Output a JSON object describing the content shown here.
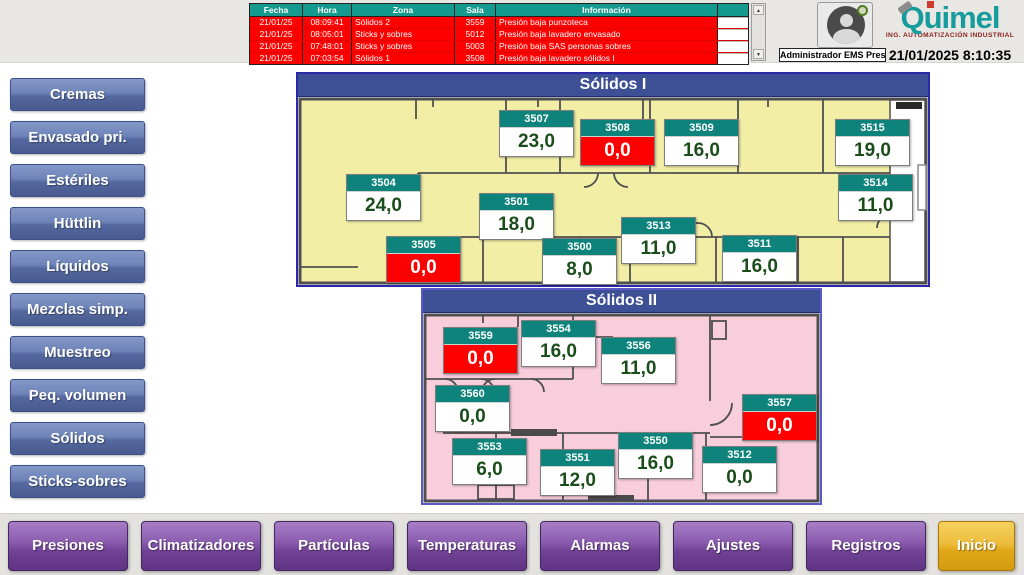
{
  "alarm_table": {
    "headers": [
      "Fecha",
      "Hora",
      "Zona",
      "Sala",
      "Información"
    ],
    "rows": [
      [
        "21/01/25",
        "08:09:41",
        "Sólidos 2",
        "3559",
        "Presión baja punzoteca"
      ],
      [
        "21/01/25",
        "08:05:01",
        "Sticks y sobres",
        "5012",
        "Presión baja lavadero envasado"
      ],
      [
        "21/01/25",
        "07:48:01",
        "Sticks y sobres",
        "5003",
        "Presión baja SAS personas sobres"
      ],
      [
        "21/01/25",
        "07:03:54",
        "Sólidos 1",
        "3508",
        "Presión baja lavadero sólidos I"
      ]
    ]
  },
  "header": {
    "user_label": "Administrador EMS Presiones",
    "logo_text": "Quimel",
    "logo_subtitle": "ING. AUTOMATIZACIÓN INDUSTRIAL",
    "datetime": "21/01/2025 8:10:35"
  },
  "icons": {
    "scroll_up": "▲",
    "scroll_down": "▼"
  },
  "sidebar": {
    "buttons": [
      "Cremas",
      "Envasado pri.",
      "Estériles",
      "Hüttlin",
      "Líquidos",
      "Mezclas simp.",
      "Muestreo",
      "Peq. volumen",
      "Sólidos",
      "Sticks-sobres"
    ]
  },
  "panels": [
    {
      "title": "Sólidos I",
      "rooms": [
        {
          "id": "3507",
          "value": "23,0",
          "alarm": false
        },
        {
          "id": "3508",
          "value": "0,0",
          "alarm": true
        },
        {
          "id": "3509",
          "value": "16,0",
          "alarm": false
        },
        {
          "id": "3515",
          "value": "19,0",
          "alarm": false
        },
        {
          "id": "3504",
          "value": "24,0",
          "alarm": false
        },
        {
          "id": "3501",
          "value": "18,0",
          "alarm": false
        },
        {
          "id": "3514",
          "value": "11,0",
          "alarm": false
        },
        {
          "id": "3505",
          "value": "0,0",
          "alarm": true
        },
        {
          "id": "3500",
          "value": "8,0",
          "alarm": false
        },
        {
          "id": "3513",
          "value": "11,0",
          "alarm": false
        },
        {
          "id": "3511",
          "value": "16,0",
          "alarm": false
        }
      ]
    },
    {
      "title": "Sólidos II",
      "rooms": [
        {
          "id": "3559",
          "value": "0,0",
          "alarm": true
        },
        {
          "id": "3554",
          "value": "16,0",
          "alarm": false
        },
        {
          "id": "3556",
          "value": "11,0",
          "alarm": false
        },
        {
          "id": "3560",
          "value": "0,0",
          "alarm": false
        },
        {
          "id": "3557",
          "value": "0,0",
          "alarm": true
        },
        {
          "id": "3553",
          "value": "6,0",
          "alarm": false
        },
        {
          "id": "3551",
          "value": "12,0",
          "alarm": false
        },
        {
          "id": "3550",
          "value": "16,0",
          "alarm": false
        },
        {
          "id": "3512",
          "value": "0,0",
          "alarm": false
        }
      ]
    }
  ],
  "bottom_nav": {
    "buttons": [
      "Presiones",
      "Climatizadores",
      "Partículas",
      "Temperaturas",
      "Alarmas",
      "Ajustes",
      "Registros",
      "Inicio"
    ],
    "active": "Inicio"
  },
  "colors": {
    "alarm_red": "#ff0000",
    "table_header_teal": "#159a90",
    "tag_header_teal": "#0e837c",
    "value_green": "#1b4d1b",
    "panel_header_blue": "#3e5095",
    "floor_yellow": "#f2eea6",
    "floor_pink": "#f8cedd",
    "sidebar_blue": "#5a6fa5",
    "nav_purple": "#7a4a9e",
    "nav_active_gold": "#e8b42d",
    "logo_teal": "#169c9c"
  }
}
